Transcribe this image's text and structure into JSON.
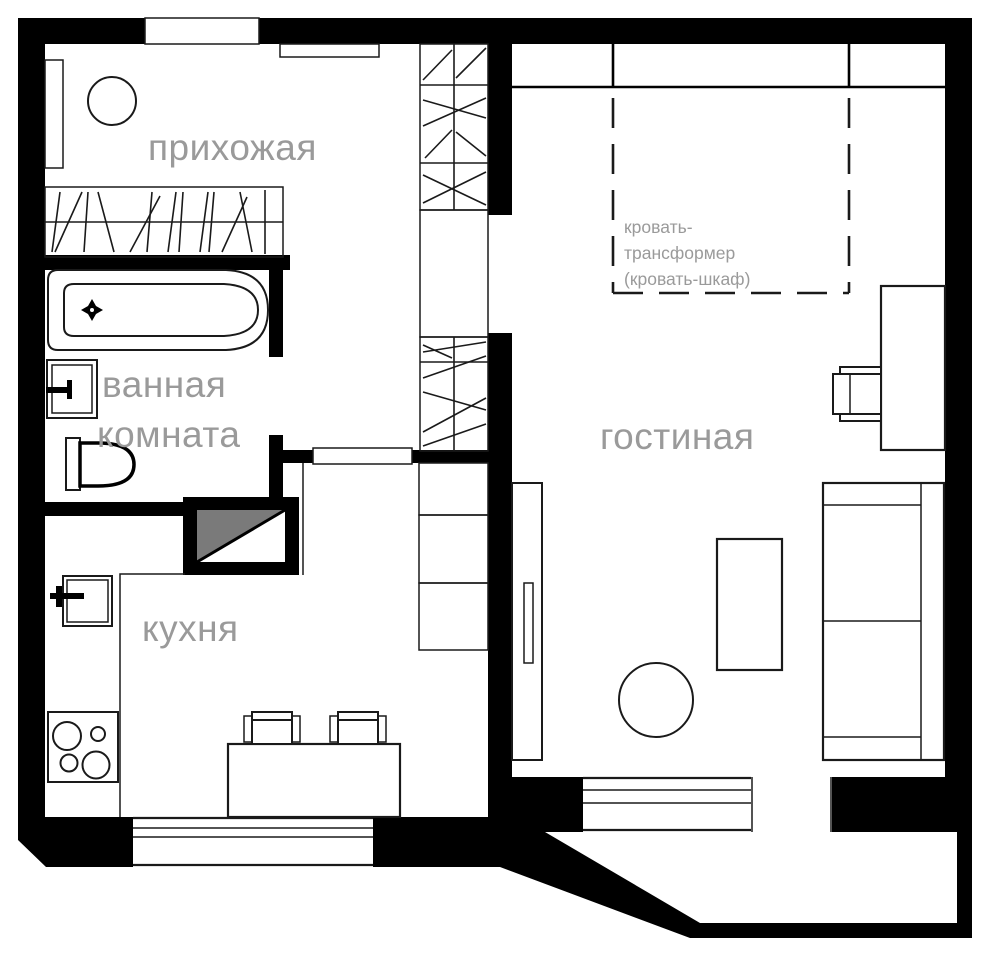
{
  "plan": {
    "type": "apartment-floor-plan",
    "language": "ru"
  },
  "rooms": {
    "hallway": {
      "label": "прихожая"
    },
    "bathroom": {
      "label_line1": "ванная",
      "label_line2": "комната"
    },
    "kitchen": {
      "label": "кухня"
    },
    "living": {
      "label": "гостиная"
    }
  },
  "annotations": {
    "bed": {
      "line1": "кровать-",
      "line2": "трансформер",
      "line3": "(кровать-шкаф)"
    }
  },
  "colors": {
    "walls": "#000000",
    "background": "#ffffff",
    "labels": "#9a9a9a",
    "appliance_fill": "#7a7a7a",
    "lines": "#1a1a1a"
  }
}
